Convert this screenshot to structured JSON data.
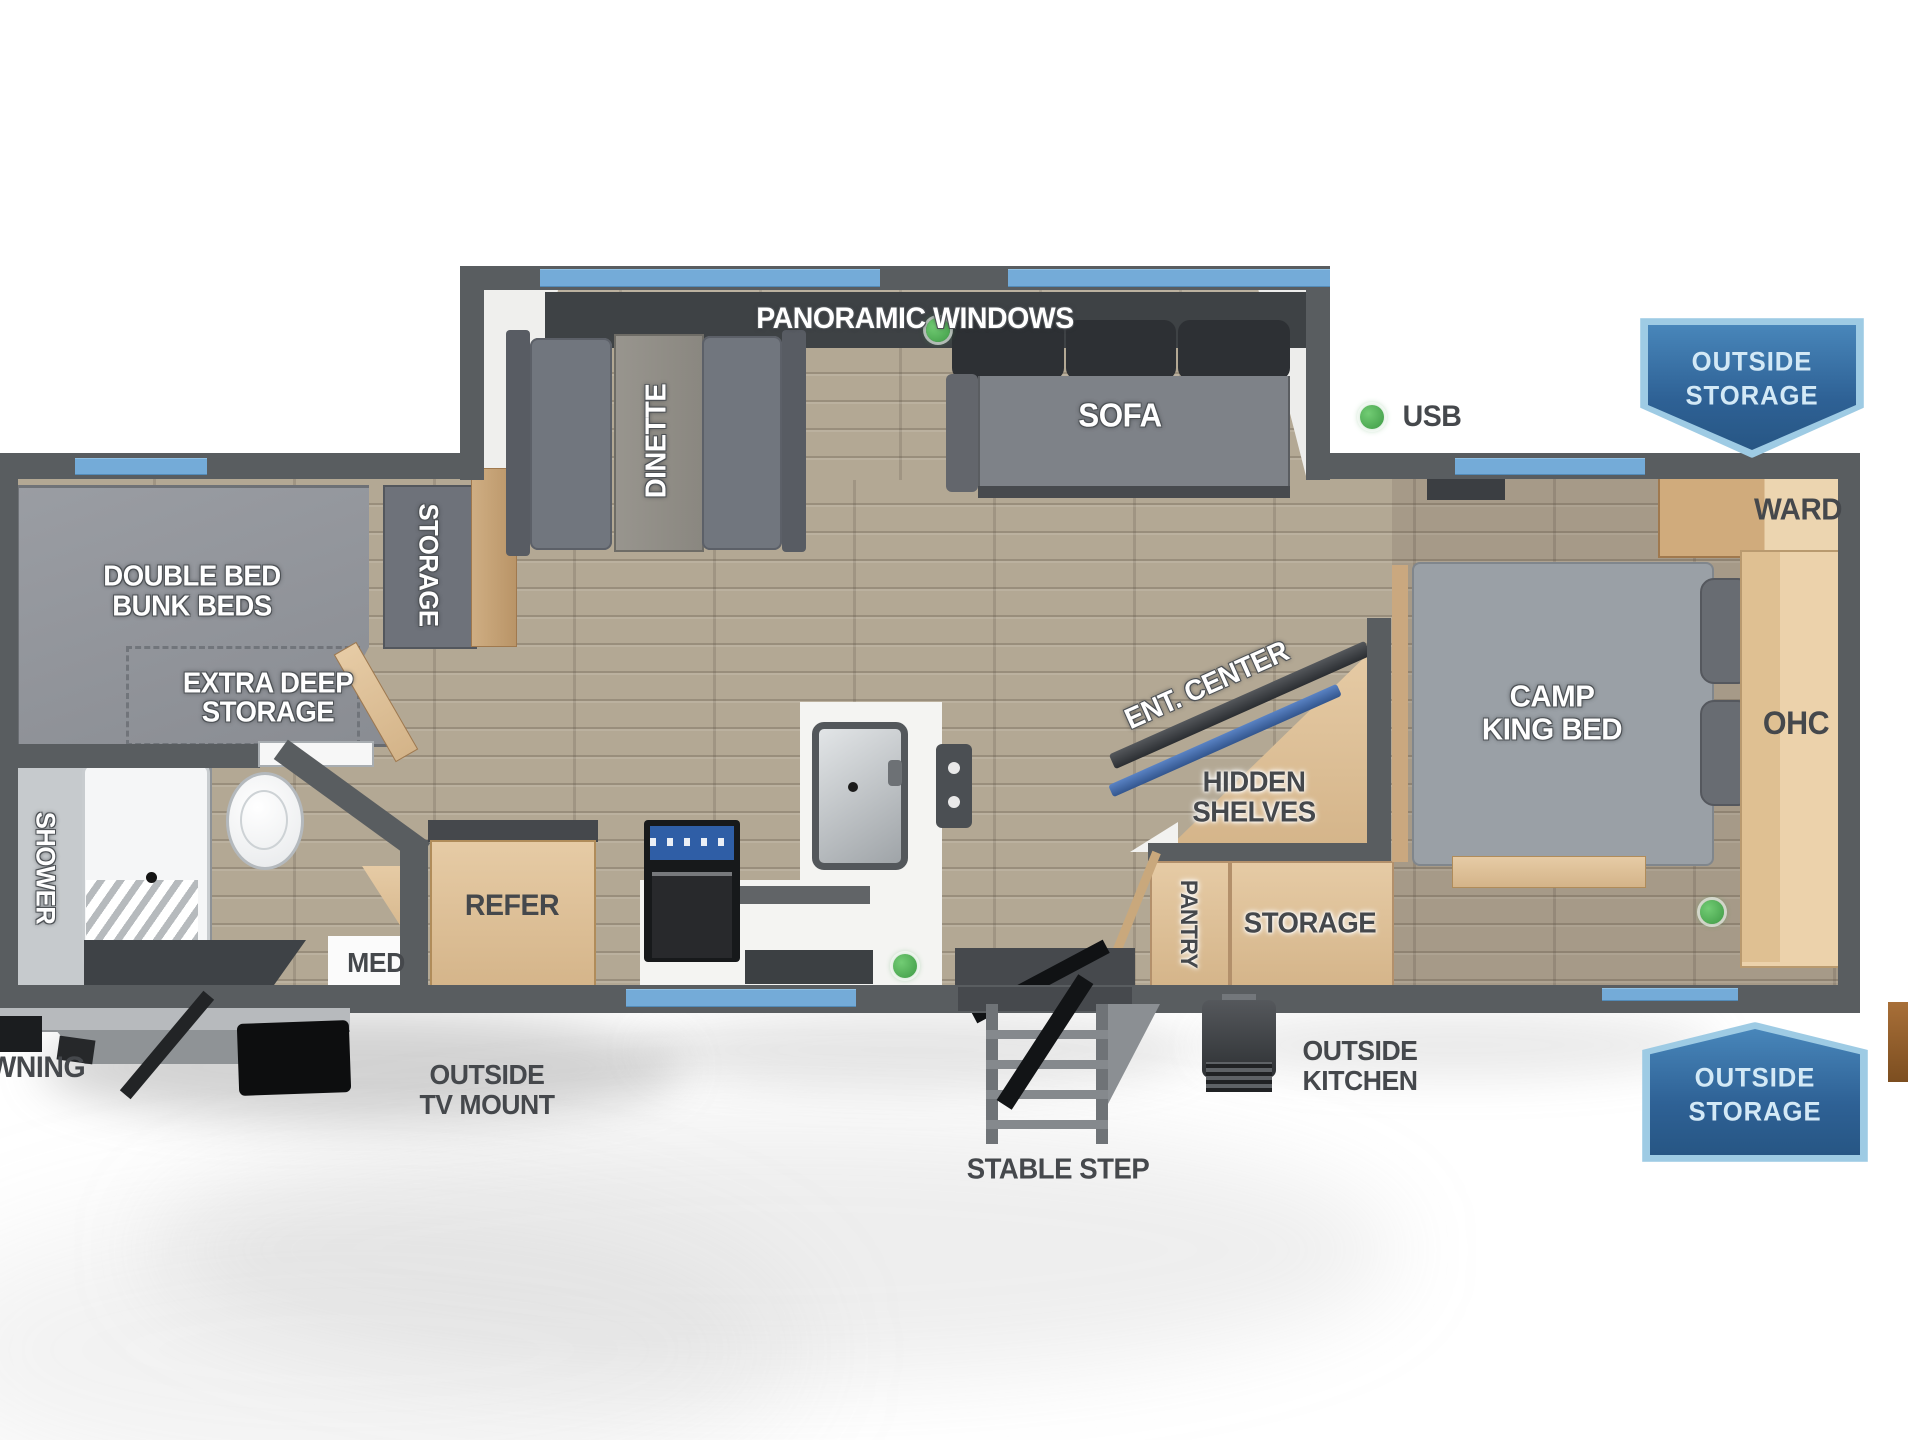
{
  "labels": {
    "panoramic_windows": "PANORAMIC WINDOWS",
    "dinette": "DINETTE",
    "sofa": "SOFA",
    "usb": "USB",
    "outside_storage_line1": "OUTSIDE",
    "outside_storage_line2": "STORAGE",
    "double_bed": "DOUBLE BED",
    "bunk_beds": "BUNK BEDS",
    "bunk_storage": "STORAGE",
    "extra_deep_line1": "EXTRA DEEP",
    "extra_deep_line2": "STORAGE",
    "shower": "SHOWER",
    "med": "MED",
    "refer": "REFER",
    "ent_center": "ENT. CENTER",
    "hidden_line1": "HIDDEN",
    "hidden_line2": "SHELVES",
    "pantry": "PANTRY",
    "bedroom_storage": "STORAGE",
    "camp": "CAMP",
    "king_bed": "KING BED",
    "ward": "WARD",
    "ohc": "OHC",
    "awning": "AWNING",
    "outside_tv_line1": "OUTSIDE",
    "outside_tv_line2": "TV MOUNT",
    "stable_step": "STABLE STEP",
    "outside_kitchen_line1": "OUTSIDE",
    "outside_kitchen_line2": "KITCHEN"
  },
  "colors": {
    "wall": "#595d60",
    "window_blue": "#74abd8",
    "banner_blue": "#2e6195",
    "usb_green": "#4caf50",
    "wood": "#dcc09a",
    "floor": "#b3a894"
  }
}
